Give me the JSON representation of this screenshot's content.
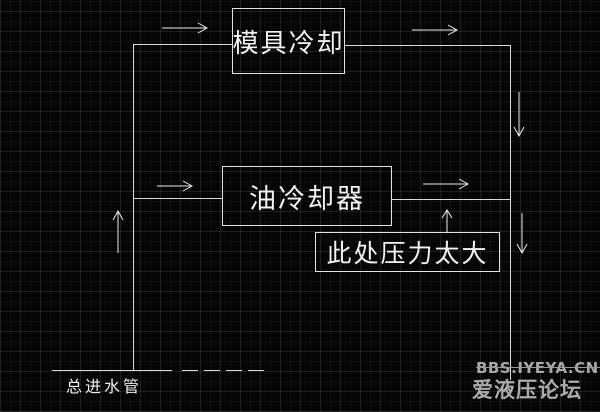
{
  "colors": {
    "background": "#050505",
    "grid_line": "#1a1a1a",
    "drawing_line": "#d9d9d9",
    "text": "#f2f2f2",
    "watermark": "#a8a8a8"
  },
  "diagram": {
    "nodes": [
      {
        "id": "mold-cooling",
        "label": "模具冷却"
      },
      {
        "id": "oil-cooler",
        "label": "油冷却器"
      },
      {
        "id": "pressure-warning",
        "label": "此处压力太大"
      }
    ],
    "labels": [
      {
        "id": "main-water-inlet",
        "label": "总进水管"
      }
    ],
    "arrows": [
      {
        "id": "top-left-flow",
        "direction": "right"
      },
      {
        "id": "top-right-flow",
        "direction": "right"
      },
      {
        "id": "right-riser-upper-flow",
        "direction": "down"
      },
      {
        "id": "mid-left-flow",
        "direction": "right"
      },
      {
        "id": "mid-right-flow",
        "direction": "right"
      },
      {
        "id": "pressure-point-flow",
        "direction": "up"
      },
      {
        "id": "left-riser-flow",
        "direction": "up"
      },
      {
        "id": "right-riser-lower-flow",
        "direction": "down"
      }
    ],
    "line_style": {
      "main": "solid",
      "inlet_tail": "dashed"
    }
  },
  "watermark": {
    "line1": "BBS.IYEYA.CN",
    "line2": "爱液压论坛"
  }
}
